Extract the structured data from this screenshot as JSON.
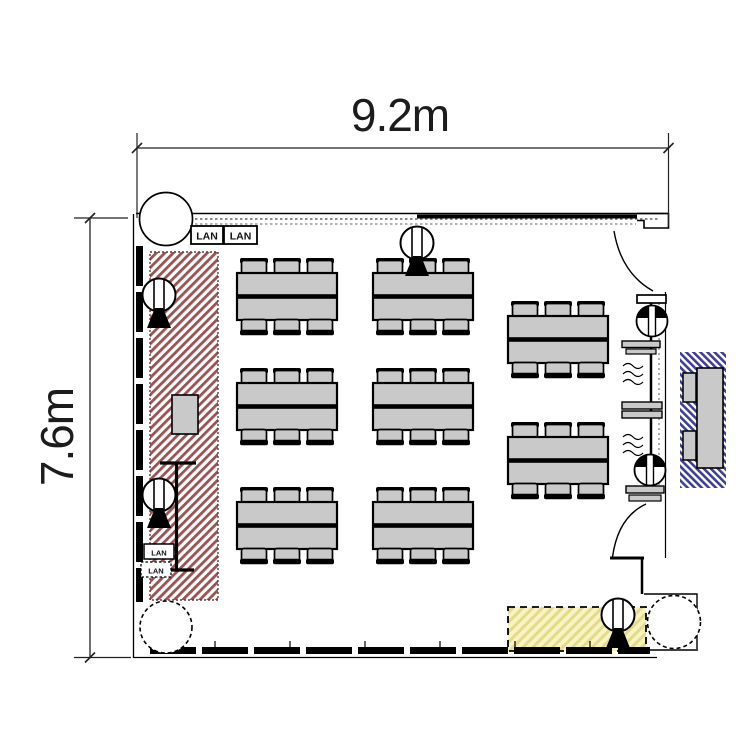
{
  "plan": {
    "type": "meeting-room floor plan",
    "room": {
      "width_label": "9.2m",
      "height_label": "7.6m"
    },
    "labels": {
      "lan_outlets_top": [
        "LAN",
        "LAN"
      ],
      "lan_outlets_left": [
        "LAN",
        "LAN"
      ]
    },
    "furniture": {
      "table_groups": 8,
      "chairs_per_table_group": 6,
      "total_seats": 48,
      "layout": "3 rows x 2 columns at left/center, 2 tables at right column"
    },
    "equipment": {
      "cameras": 4,
      "wall_speakers": 2,
      "projection_screen": 1,
      "lectern_cabinet": 1,
      "doors_right_wall": 2,
      "corner_columns": 3
    },
    "colors": {
      "line": "#000000",
      "furniture_fill": "#c9c9c9",
      "red_zone_stripe": "#9a5252",
      "blue_zone_stripe": "#3f3f96",
      "yellow_zone_fill": "#f8f4c0",
      "yellow_zone_stripe": "#e4da8e"
    }
  }
}
